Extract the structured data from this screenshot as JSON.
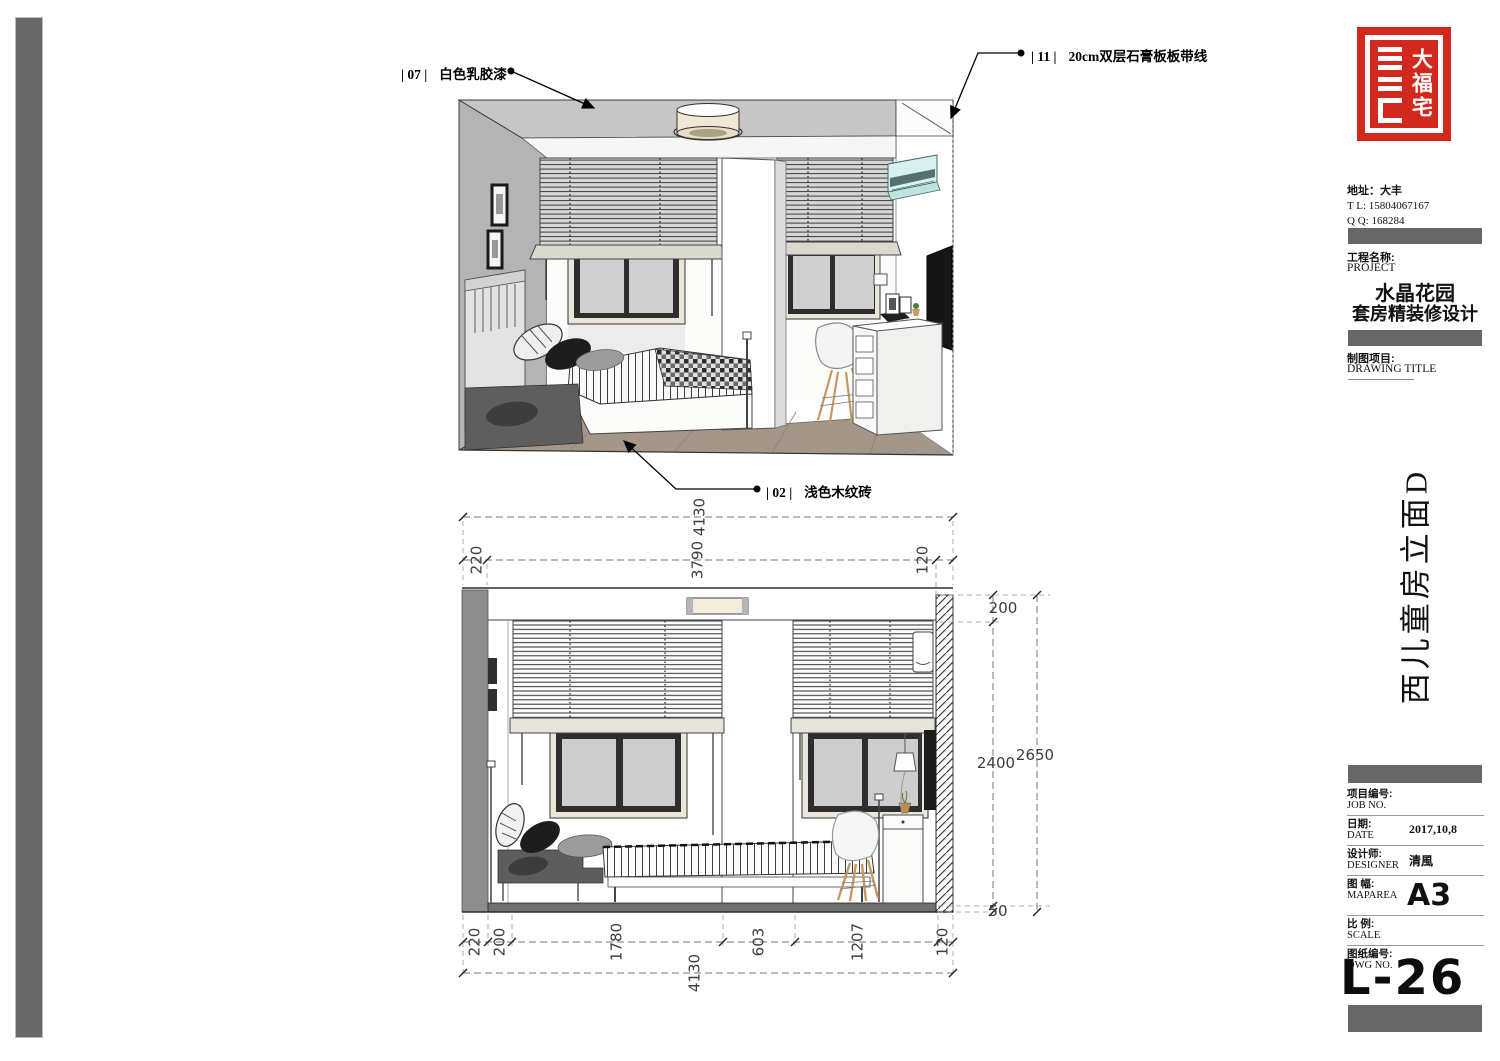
{
  "colors": {
    "accent_red": "#d3281e",
    "bar_gray": "#676767",
    "dim_text": "#3d3d3d"
  },
  "callouts": [
    {
      "code": "| 07 |",
      "label": "白色乳胶漆"
    },
    {
      "code": "| 11 |",
      "label": "20cm双层石膏板板带线"
    },
    {
      "code": "| 02 |",
      "label": "浅色木纹砖"
    }
  ],
  "title_block": {
    "logo_chars": "大福宅",
    "contact": {
      "address": "地址：大丰",
      "tel": "T  L:   15804067167",
      "qq": "Q  Q:   168284"
    },
    "project": {
      "label_cn": "工程名称:",
      "label_en": "PROJECT",
      "name_line1": "水晶花园",
      "name_line2": "套房精装修设计"
    },
    "drawing": {
      "label_cn": "制图项目:",
      "label_en": "DRAWING TITLE",
      "title_vertical": "西儿童房立面D"
    },
    "fields": [
      {
        "cn": "项目编号:",
        "en": "JOB NO.",
        "value": ""
      },
      {
        "cn": "日期:",
        "en": "DATE",
        "value": "2017,10,8"
      },
      {
        "cn": "设计师:",
        "en": "DESIGNER",
        "value": "清風"
      },
      {
        "cn": "图 幅:",
        "en": "MAPAREA",
        "value": "A3"
      },
      {
        "cn": "比 例:",
        "en": "SCALE",
        "value": ""
      },
      {
        "cn": "图纸编号:",
        "en": "DWG NO.",
        "value": ""
      }
    ],
    "sheet_number": "L-26"
  },
  "dimensions": {
    "top_total": "4130",
    "top_left": "220",
    "top_mid": "3790",
    "top_right": "120",
    "right_ceiling": "200",
    "right_room": "2400",
    "right_total": "2650",
    "right_floor": "50",
    "bottom_segments": [
      "220",
      "200",
      "1780",
      "603",
      "1207",
      "120"
    ],
    "bottom_total": "4130"
  }
}
